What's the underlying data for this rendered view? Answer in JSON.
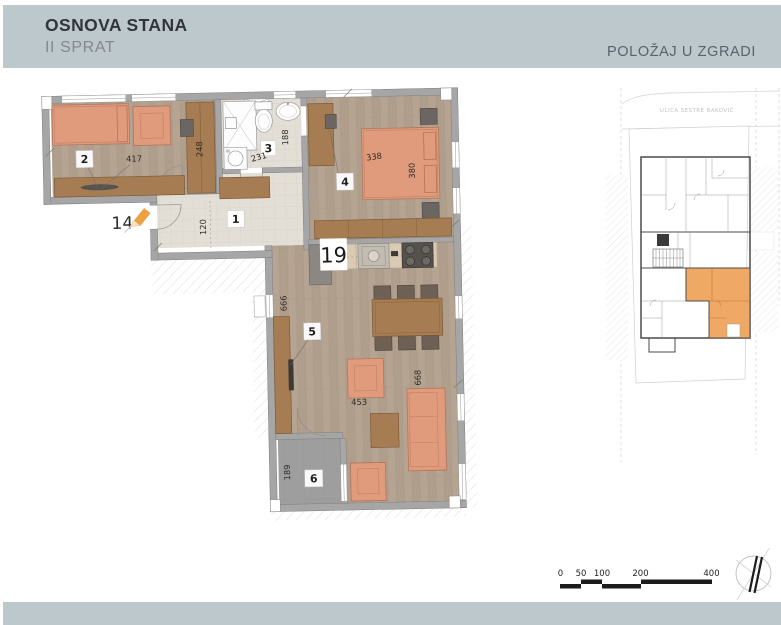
{
  "header": {
    "title": "OSNOVA STANA",
    "subtitle": "II SPRAT",
    "right_label": "POLOŽAJ U ZGRADI"
  },
  "plan": {
    "apartment_marker": "14",
    "kitchen_marker": "19",
    "closet_dim": "248",
    "rooms": [
      {
        "number": "1",
        "dim": "120"
      },
      {
        "number": "2",
        "dim": "417"
      },
      {
        "number": "3",
        "dim_width": "231",
        "dim_depth": "188"
      },
      {
        "number": "4",
        "dim_width": "338",
        "dim_depth": "380"
      },
      {
        "number": "5",
        "dim_wall": "666",
        "dim_mid": "453",
        "dim_right": "668"
      },
      {
        "number": "6",
        "dim": "189"
      }
    ]
  },
  "site_map": {
    "street_name": "ULICA SESTRE BAKOVIĆ"
  },
  "scale_bar": {
    "ticks": [
      "0",
      "50",
      "100",
      "200",
      "400"
    ]
  },
  "colors": {
    "band": "#bdc8cd",
    "accent_orange": "#f0a865",
    "furniture_orange": "#e09a7c",
    "furniture_brown": "#a67c52",
    "wall_gray": "#a6a6a6"
  }
}
